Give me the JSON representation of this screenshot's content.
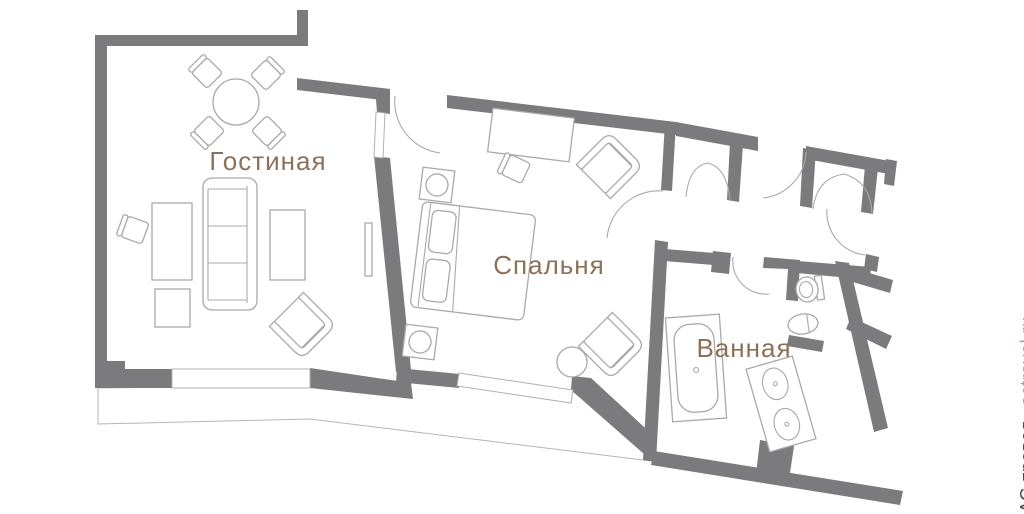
{
  "plan": {
    "rooms": [
      {
        "id": "living-room",
        "label": "Гостиная",
        "furniture": [
          "dining-table",
          "dining-chairs-4",
          "sofa",
          "console-table",
          "writing-desk",
          "desk-chair",
          "side-table",
          "armchair",
          "radiator",
          "window"
        ]
      },
      {
        "id": "bedroom",
        "label": "Спальня",
        "furniture": [
          "double-bed",
          "pillows",
          "nightstand-lamps-2",
          "writing-desk",
          "desk-chair",
          "armchair-2",
          "round-table",
          "window"
        ]
      },
      {
        "id": "bathroom",
        "label": "Ванная",
        "furniture": [
          "bathtub",
          "toilet",
          "bidet",
          "double-sink-vanity"
        ]
      }
    ],
    "features": [
      "entrance-hall",
      "bifold-closet-doors",
      "balcony",
      "door-swing-arcs"
    ]
  },
  "watermark": {
    "company": "АС-тревел",
    "separator": "·",
    "site": "actravel.ru"
  },
  "colors": {
    "wall": "#7b7a7d",
    "furniture_outline": "#a9a9ac",
    "room_label": "#8b7158",
    "watermark_text": "#464751",
    "watermark_link": "#82aad5",
    "background": "#ffffff"
  }
}
